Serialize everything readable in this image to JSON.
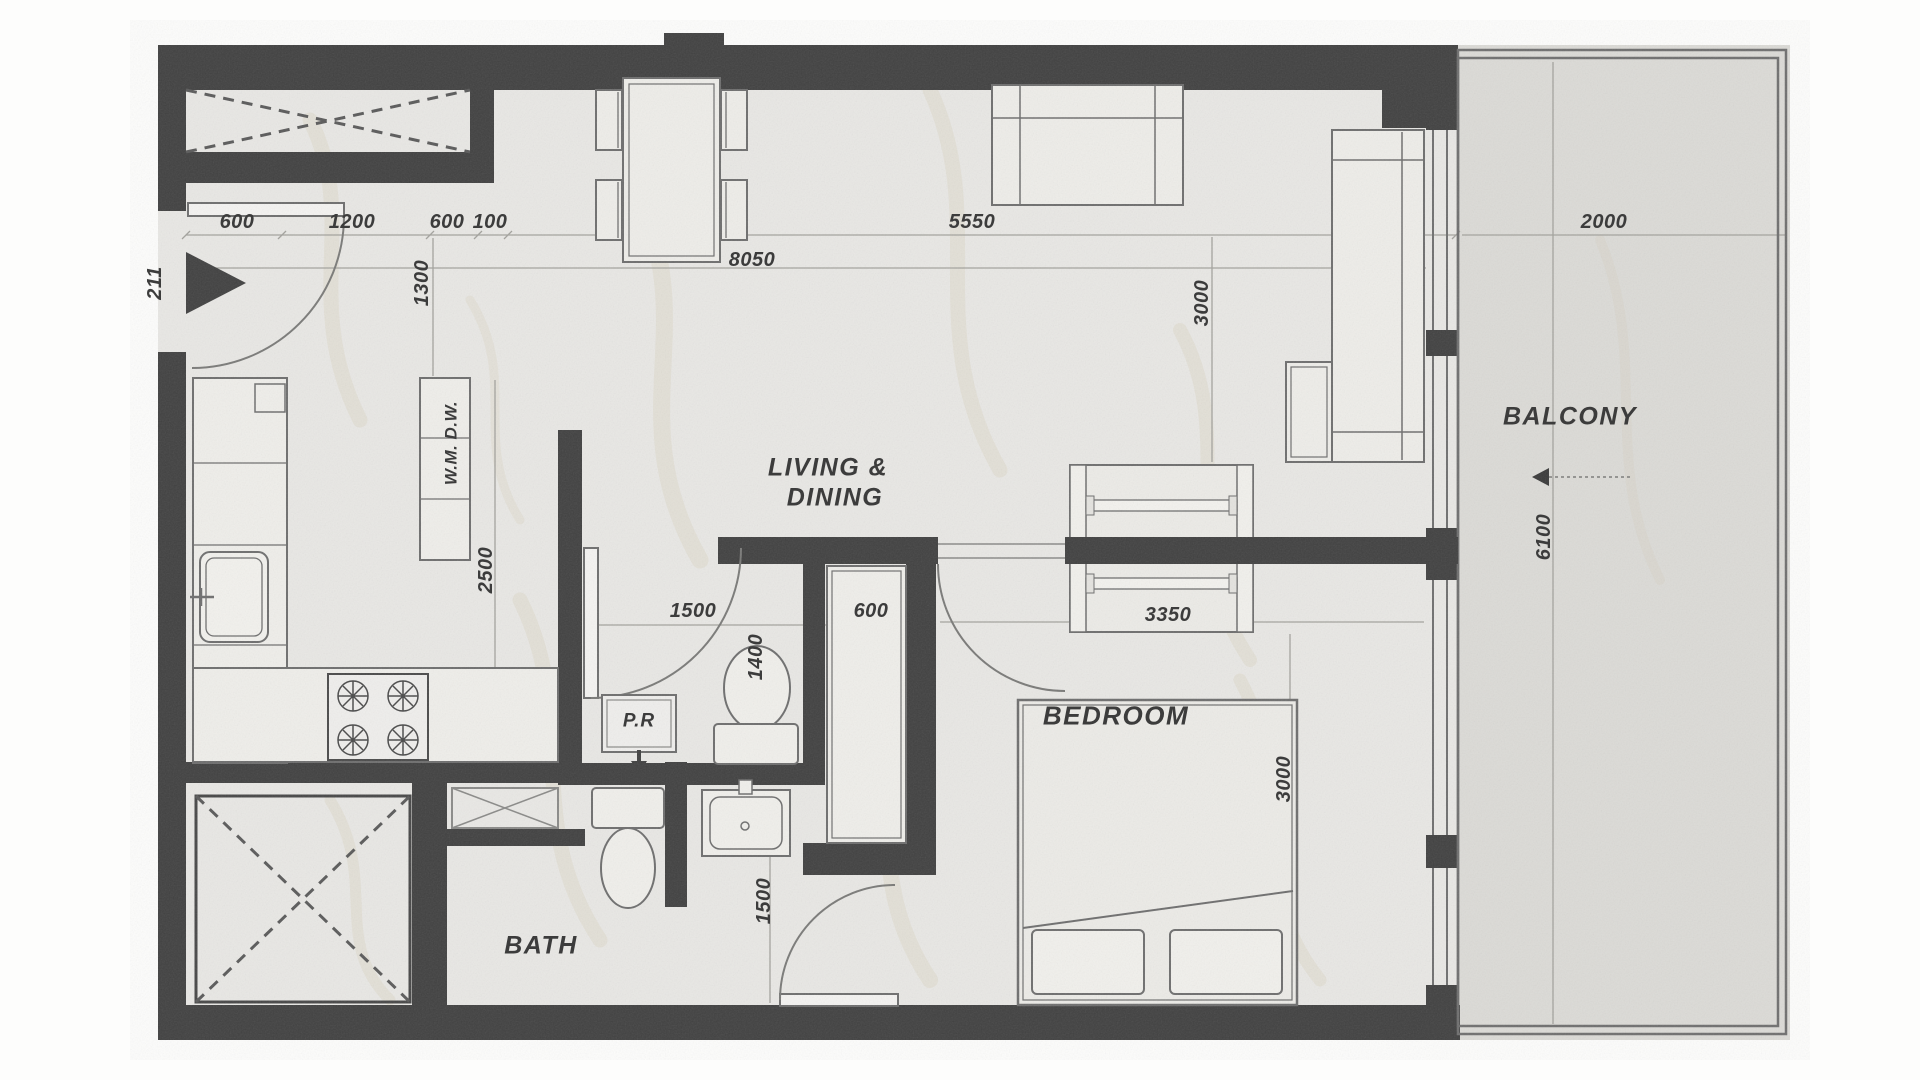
{
  "title": "apartment-floor-plan",
  "colors": {
    "wall": "#414141",
    "floor": "#e9e8e5",
    "balcony_floor": "#dcdbd7",
    "furniture_line": "#6e6e6e",
    "dim_line": "#a3a29d",
    "text": "#3c3c3c",
    "vein": "#c8ba92"
  },
  "rooms": {
    "living_dining_line1": "LIVING &",
    "living_dining_line2": "DINING",
    "bedroom": "BEDROOM",
    "bath": "BATH",
    "balcony": "BALCONY",
    "powder_room": "P.R"
  },
  "appliances": {
    "washer_dishwasher": "W.M. D.W."
  },
  "dims": {
    "entry_offset": "211",
    "top_600a": "600",
    "top_1200": "1200",
    "top_600b": "600",
    "top_100": "100",
    "living_overall": "8050",
    "living_top": "5550",
    "balcony_width": "2000",
    "kitchen_passage": "1300",
    "kitchen_run": "2500",
    "living_depth": "3000",
    "balcony_length": "6100",
    "pr_width": "1500",
    "pr_depth": "1400",
    "closet_depth": "600",
    "wardrobe_width": "3350",
    "hall_width": "1500",
    "bedroom_depth": "3000"
  }
}
